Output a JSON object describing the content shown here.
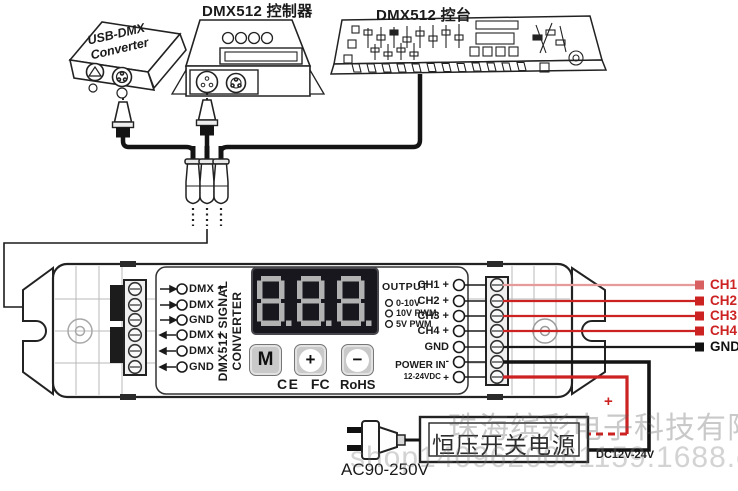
{
  "titles": {
    "usb_line1": "USB-DMX",
    "usb_line2": "Converter",
    "controller": "DMX512 控制器",
    "console": "DMX512 控台"
  },
  "converter_unit": {
    "vertical_name_line1": "DMX512 SIGNAL",
    "vertical_name_line2": "CONVERTER",
    "display_value": "8.8.8.",
    "dmx_terminals": [
      {
        "label": "DMX +"
      },
      {
        "label": "DMX -"
      },
      {
        "label": "GND"
      },
      {
        "label": "DMX +"
      },
      {
        "label": "DMX -"
      },
      {
        "label": "GND"
      }
    ],
    "output_heading": "OUTPUT",
    "output_options": [
      {
        "label": "0-10V"
      },
      {
        "label": "10V PWM"
      },
      {
        "label": "5V PWM"
      }
    ],
    "button_mode": "M",
    "button_plus": "+",
    "button_minus": "−",
    "cert_ce": "CE",
    "cert_fcc": "FC",
    "cert_rohs": "RoHS",
    "right_terminals": [
      {
        "label": "CH1 +"
      },
      {
        "label": "CH2 +"
      },
      {
        "label": "CH3 +"
      },
      {
        "label": "CH4 +"
      },
      {
        "label": "GND"
      }
    ],
    "power_label": "POWER IN",
    "power_minus": "-",
    "power_voltage": "12-24VDC",
    "power_plus": "+"
  },
  "wiring": {
    "channels": [
      {
        "label": "CH1"
      },
      {
        "label": "CH2"
      },
      {
        "label": "CH3"
      },
      {
        "label": "CH4"
      }
    ],
    "ground_label": "GND",
    "positive_marker": "+"
  },
  "power_supply": {
    "label": "恒压开关电源",
    "ac_rating": "AC90-250V",
    "dc_rating": "DC12V-24V"
  },
  "watermark": {
    "line1": "珠海缤彩电子科技有限公司",
    "line2": "shop1409620061159.1688.com"
  },
  "colors": {
    "channel_red": "#cc2222",
    "wire_black": "#1a1a1a",
    "display_bg": "#17171d",
    "segment_gray": "#b2b2b2"
  }
}
